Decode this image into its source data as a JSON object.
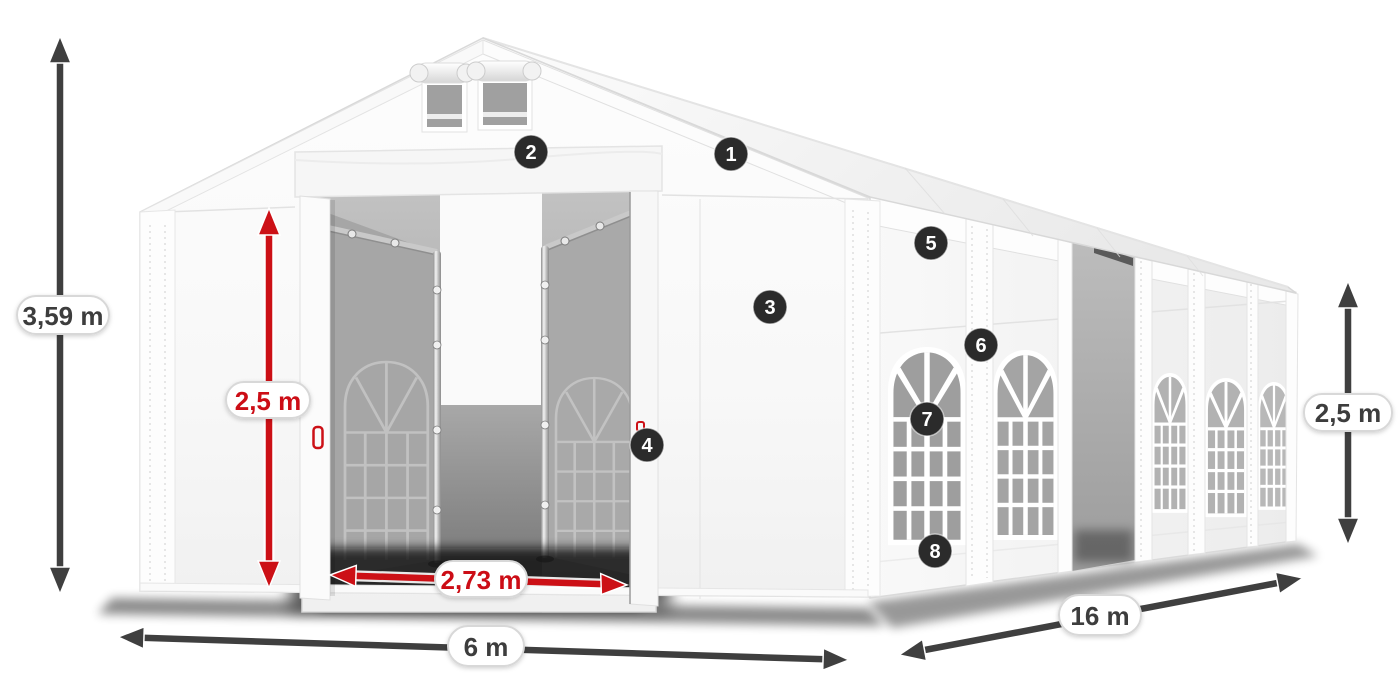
{
  "diagram": {
    "subject": "White marquee storage tent with dimension annotations",
    "dimensions": {
      "total_height": {
        "label": "3,59 m"
      },
      "entrance_height": {
        "label": "2,5 m"
      },
      "entrance_width": {
        "label": "2,73 m"
      },
      "front_width": {
        "label": "6 m"
      },
      "side_length": {
        "label": "16 m"
      },
      "side_wall_height": {
        "label": "2,5 m"
      }
    },
    "hotspots": [
      "1",
      "2",
      "3",
      "4",
      "5",
      "6",
      "7",
      "8"
    ]
  },
  "colors": {
    "dimension-red": "#cc1016",
    "arrow-dark": "#3f3f3f",
    "badge-bg": "#2b2b2b",
    "pill-border": "#d8d8d8",
    "text-dark": "#3c3c3c"
  }
}
